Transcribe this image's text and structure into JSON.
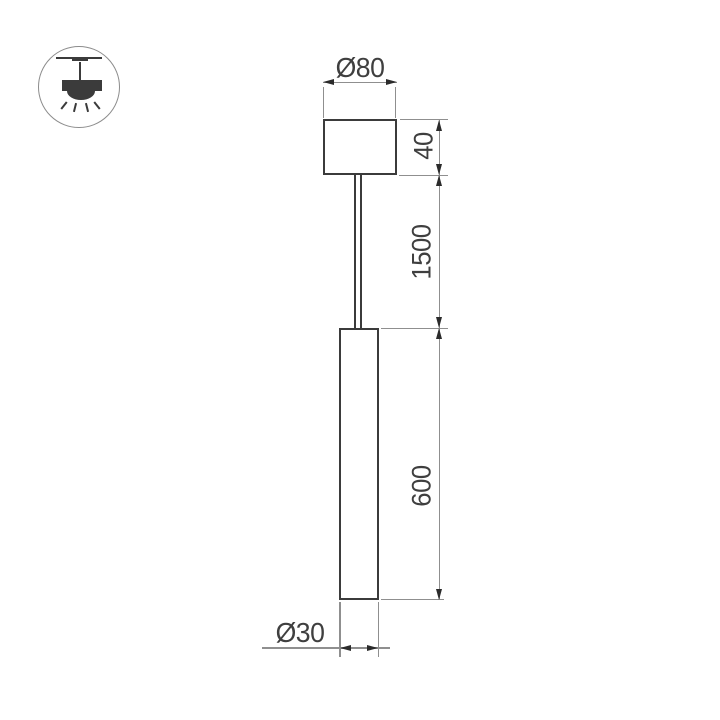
{
  "legend": {
    "icon": "ceiling-pendant-light-icon"
  },
  "drawing": {
    "type": "technical-dimension-drawing",
    "labels": {
      "canopy_diameter": "Ø80",
      "canopy_height": "40",
      "suspension_length": "1500",
      "body_length": "600",
      "body_diameter": "Ø30"
    },
    "colors": {
      "outline": "#3b3b3b",
      "dimension_line": "#8f8f8f",
      "arrowhead": "#2b2b2b",
      "text": "#3f3f3f",
      "background": "#ffffff"
    }
  }
}
